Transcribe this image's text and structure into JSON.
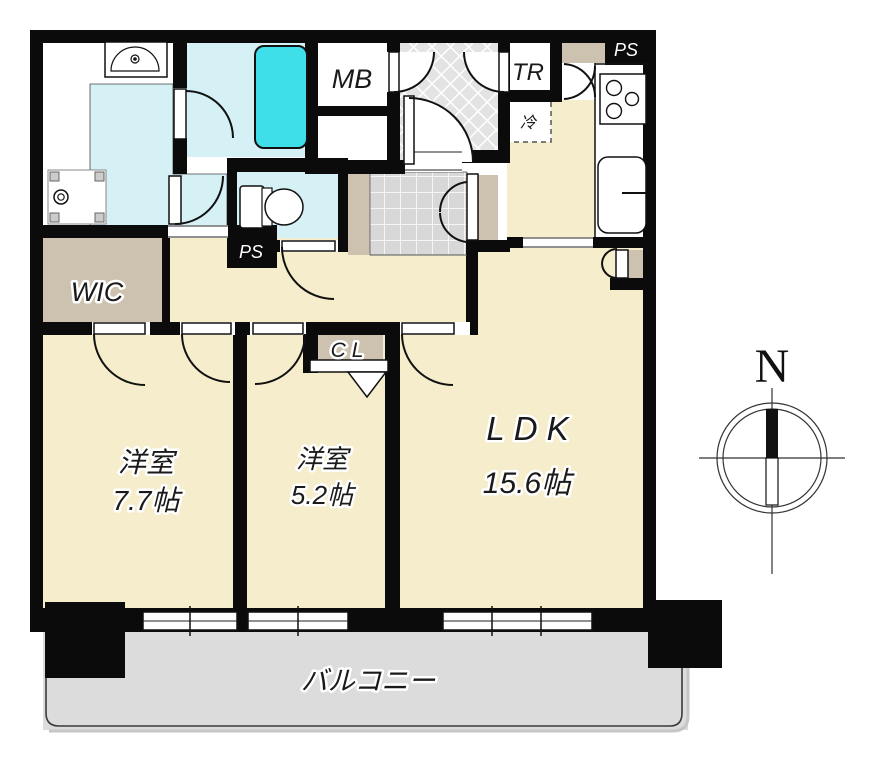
{
  "floorplan": {
    "compass": {
      "north_label": "N"
    },
    "balcony": {
      "label": "バルコニー"
    },
    "rooms": {
      "living_dining_kitchen": {
        "name": "LDK",
        "area": "15.6帖"
      },
      "bedroom_1": {
        "name": "洋室",
        "area": "7.7帖"
      },
      "bedroom_2": {
        "name": "洋室",
        "area": "5.2帖"
      },
      "walk_in_closet": {
        "label": "WIC"
      },
      "closet": {
        "label": "CL"
      },
      "meter_box": {
        "label": "MB"
      },
      "trunk_room": {
        "label": "TR"
      },
      "refrigerator_space": {
        "label": "冷"
      },
      "pipe_space_kitchen": {
        "label": "PS"
      },
      "pipe_space_hall": {
        "label": "PS"
      }
    },
    "colors": {
      "room_floor": "#f5edcb",
      "closet_floor": "#cdc2b0",
      "wet_area_floor": "#d5f1f6",
      "bathtub": "#3edfe9",
      "balcony_floor": "#dcdcdc",
      "entrance_tile": "#d8d8d8",
      "wall": "#0b0b0b"
    }
  }
}
